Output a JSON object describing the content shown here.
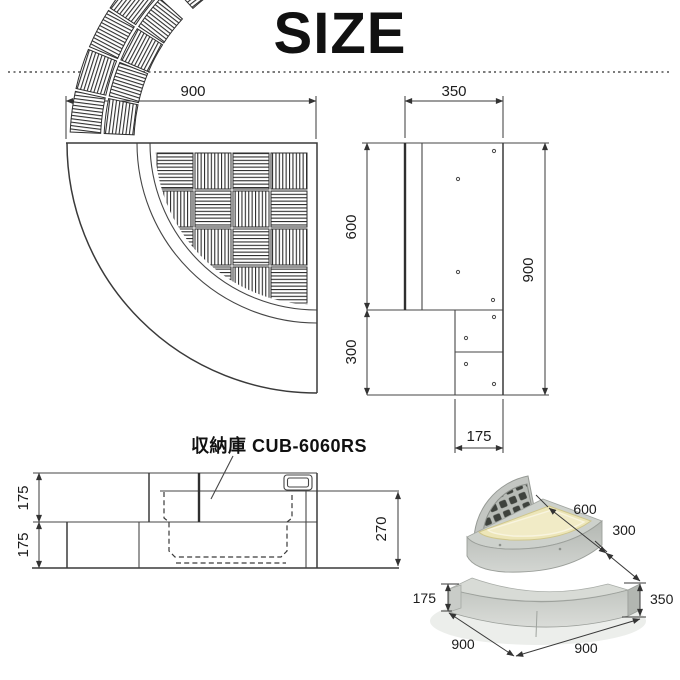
{
  "title": "SIZE",
  "views": {
    "plan": {
      "dim_width": "900"
    },
    "side": {
      "dim_top": "350",
      "dim_upper": "600",
      "dim_lower": "300",
      "dim_total": "900",
      "dim_step": "175"
    },
    "front": {
      "label": "収納庫 CUB-6060RS",
      "dim_upper": "175",
      "dim_lower": "175",
      "dim_depth": "270"
    },
    "iso": {
      "dim_upper_depth": "600",
      "dim_lower_depth": "300",
      "dim_height": "350",
      "dim_step": "175",
      "dim_width_left": "900",
      "dim_width_right": "900"
    }
  },
  "colors": {
    "line": "#3a3a3a",
    "body_gray": "#cfd2ce",
    "tub_cream": "#ede6b8",
    "lid_grid_dark": "#3e423d"
  }
}
